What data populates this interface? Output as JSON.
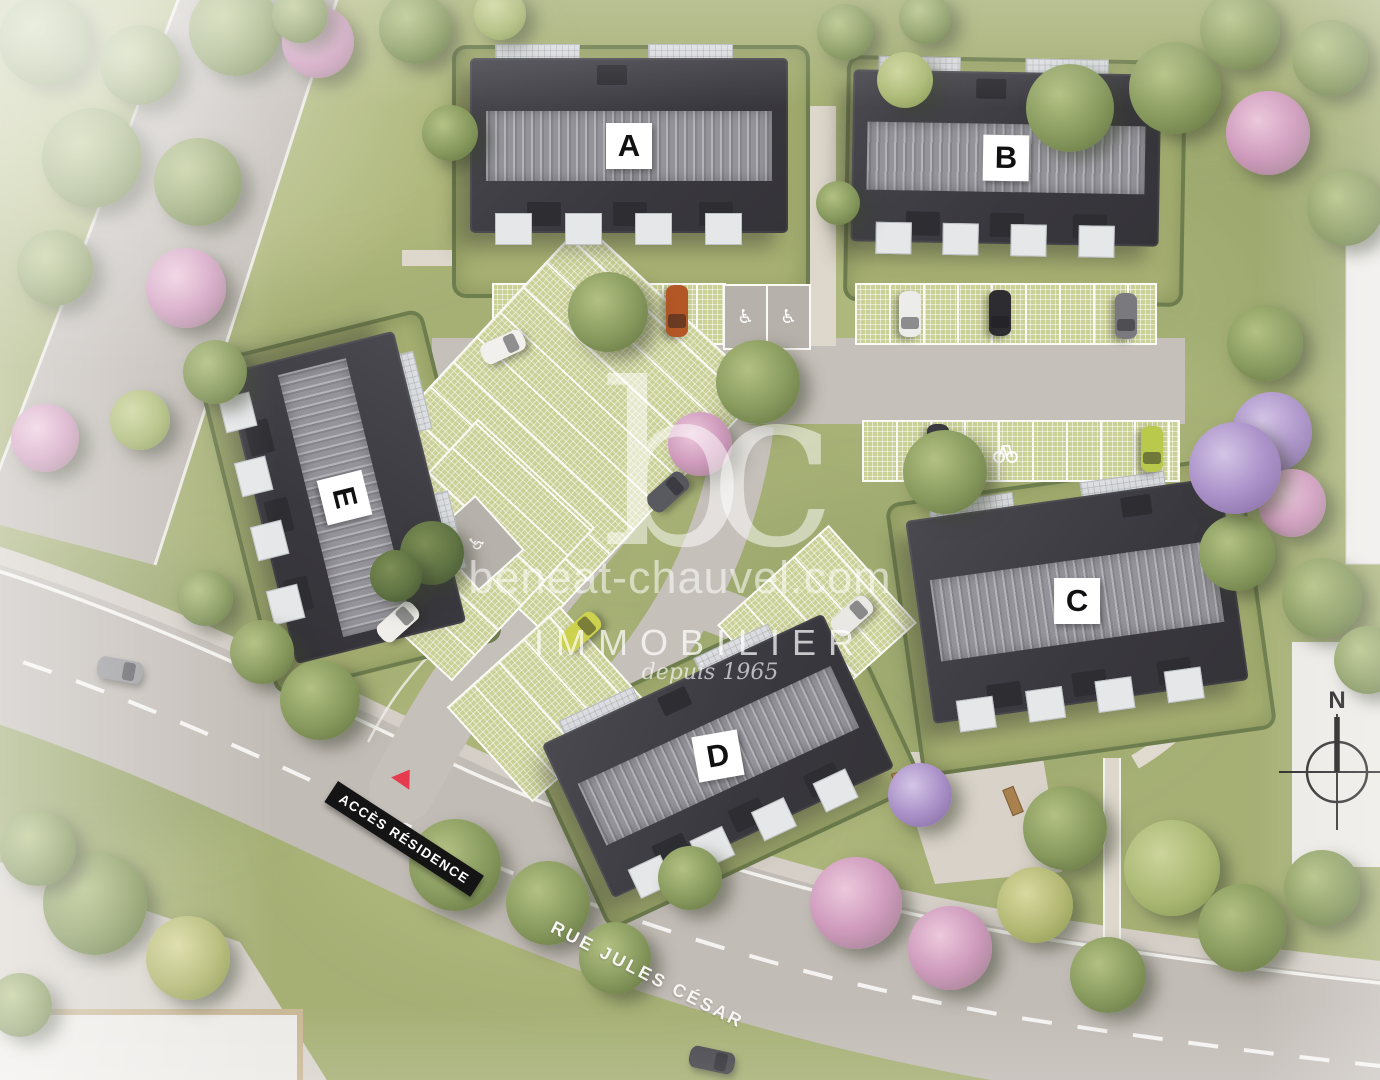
{
  "watermark": {
    "logo": "bc",
    "domain": "beneat-chauvel.com",
    "brand": "IMMOBILIER",
    "tagline": "depuis 1965"
  },
  "signs": {
    "access_residence": "ACCÈS RÉSIDENCE",
    "street_name": "RUE JULES CÉSAR",
    "compass_north": "N"
  },
  "buildings": [
    {
      "label": "A"
    },
    {
      "label": "B"
    },
    {
      "label": "C"
    },
    {
      "label": "D"
    },
    {
      "label": "E"
    }
  ],
  "icons": {
    "accessible_parking": "♿",
    "bike_rack": "bike-rack",
    "compass_rose": "compass-rose"
  },
  "colors": {
    "grass": "#a6b075",
    "roof": "#3f3e44",
    "roof_ridge": "#94939a",
    "road": "#c2bcb6",
    "paver_parking": "#cad096",
    "path": "#ded7cb",
    "label_bg": "#ffffff",
    "label_text": "#111111",
    "sign_bg": "#141414",
    "sign_text": "#ffffff",
    "sign_triangle": "#e63a4e",
    "watermark": "#ffffff"
  },
  "scene": {
    "paver_rows": [
      {
        "l": 492,
        "t": 283,
        "w": 234,
        "h": 62,
        "r": 0
      },
      {
        "l": 855,
        "t": 283,
        "w": 302,
        "h": 62,
        "r": 0
      },
      {
        "l": 862,
        "t": 420,
        "w": 318,
        "h": 62,
        "r": 0
      },
      {
        "l": 398,
        "t": 302,
        "w": 328,
        "h": 248,
        "r": -47
      },
      {
        "l": 360,
        "t": 470,
        "w": 210,
        "h": 160,
        "r": -47
      },
      {
        "l": 470,
        "t": 640,
        "w": 152,
        "h": 128,
        "r": -42
      },
      {
        "l": 742,
        "t": 558,
        "w": 150,
        "h": 132,
        "r": -42
      }
    ],
    "hc_stalls": [
      {
        "l": 723,
        "t": 284,
        "w": 84,
        "h": 62,
        "r": 0,
        "n": 2
      },
      {
        "l": 446,
        "t": 506,
        "w": 58,
        "h": 70,
        "r": -42,
        "n": 1
      }
    ],
    "cars": [
      {
        "x": 910,
        "y": 314,
        "r": 90,
        "c": "#ececea"
      },
      {
        "x": 1000,
        "y": 313,
        "r": 90,
        "c": "#2c2c31"
      },
      {
        "x": 1126,
        "y": 316,
        "r": 90,
        "c": "#7a7a7e"
      },
      {
        "x": 677,
        "y": 311,
        "r": 90,
        "c": "#b35726",
        "len": 52
      },
      {
        "x": 938,
        "y": 447,
        "r": 90,
        "c": "#3a3a40"
      },
      {
        "x": 1152,
        "y": 449,
        "r": 90,
        "c": "#b9c94c"
      },
      {
        "x": 503,
        "y": 347,
        "r": -25,
        "c": "#f1f0ed"
      },
      {
        "x": 668,
        "y": 492,
        "r": -42,
        "c": "#595960"
      },
      {
        "x": 580,
        "y": 632,
        "r": -42,
        "c": "#ccd14e"
      },
      {
        "x": 398,
        "y": 622,
        "r": -42,
        "c": "#efeeeb"
      },
      {
        "x": 852,
        "y": 616,
        "r": -42,
        "c": "#e9e8e4"
      },
      {
        "x": 120,
        "y": 670,
        "r": 10,
        "c": "#9a9a9e"
      },
      {
        "x": 712,
        "y": 1060,
        "r": 12,
        "c": "#46464c"
      }
    ],
    "benches": [
      {
        "x": 905,
        "y": 775,
        "r": -15
      },
      {
        "x": 1012,
        "y": 800,
        "r": 68
      }
    ],
    "trees": [
      {
        "x": 45,
        "y": 40,
        "rad": 46,
        "t": "g"
      },
      {
        "x": 140,
        "y": 65,
        "rad": 40,
        "t": "g"
      },
      {
        "x": 235,
        "y": 30,
        "rad": 46,
        "t": "g"
      },
      {
        "x": 318,
        "y": 42,
        "rad": 36,
        "t": "pk"
      },
      {
        "x": 300,
        "y": 15,
        "rad": 28,
        "t": "g"
      },
      {
        "x": 415,
        "y": 28,
        "rad": 36,
        "t": "g"
      },
      {
        "x": 500,
        "y": 14,
        "rad": 26,
        "t": "lg"
      },
      {
        "x": 92,
        "y": 158,
        "rad": 50,
        "t": "g"
      },
      {
        "x": 198,
        "y": 182,
        "rad": 44,
        "t": "g"
      },
      {
        "x": 55,
        "y": 268,
        "rad": 38,
        "t": "g"
      },
      {
        "x": 186,
        "y": 288,
        "rad": 40,
        "t": "pk"
      },
      {
        "x": 45,
        "y": 438,
        "rad": 34,
        "t": "pk"
      },
      {
        "x": 140,
        "y": 420,
        "rad": 30,
        "t": "lg"
      },
      {
        "x": 215,
        "y": 372,
        "rad": 32,
        "t": "g"
      },
      {
        "x": 845,
        "y": 32,
        "rad": 28,
        "t": "g"
      },
      {
        "x": 925,
        "y": 18,
        "rad": 26,
        "t": "g"
      },
      {
        "x": 905,
        "y": 80,
        "rad": 28,
        "t": "lg"
      },
      {
        "x": 1070,
        "y": 108,
        "rad": 44,
        "t": "g"
      },
      {
        "x": 1175,
        "y": 88,
        "rad": 46,
        "t": "g"
      },
      {
        "x": 1268,
        "y": 133,
        "rad": 42,
        "t": "pk"
      },
      {
        "x": 1345,
        "y": 208,
        "rad": 38,
        "t": "g"
      },
      {
        "x": 1240,
        "y": 30,
        "rad": 40,
        "t": "g"
      },
      {
        "x": 1330,
        "y": 58,
        "rad": 38,
        "t": "g"
      },
      {
        "x": 1265,
        "y": 343,
        "rad": 38,
        "t": "g"
      },
      {
        "x": 1272,
        "y": 432,
        "rad": 40,
        "t": "pu"
      },
      {
        "x": 1292,
        "y": 503,
        "rad": 34,
        "t": "pk"
      },
      {
        "x": 1237,
        "y": 553,
        "rad": 38,
        "t": "g"
      },
      {
        "x": 1322,
        "y": 598,
        "rad": 40,
        "t": "g"
      },
      {
        "x": 1368,
        "y": 660,
        "rad": 34,
        "t": "g"
      },
      {
        "x": 945,
        "y": 472,
        "rad": 42,
        "t": "g"
      },
      {
        "x": 1235,
        "y": 468,
        "rad": 46,
        "t": "pu"
      },
      {
        "x": 608,
        "y": 312,
        "rad": 40,
        "t": "g"
      },
      {
        "x": 758,
        "y": 382,
        "rad": 42,
        "t": "g"
      },
      {
        "x": 700,
        "y": 444,
        "rad": 32,
        "t": "pk"
      },
      {
        "x": 432,
        "y": 553,
        "rad": 32,
        "t": "dg"
      },
      {
        "x": 396,
        "y": 576,
        "rad": 26,
        "t": "dg"
      },
      {
        "x": 450,
        "y": 133,
        "rad": 28,
        "t": "g"
      },
      {
        "x": 838,
        "y": 203,
        "rad": 22,
        "t": "g"
      },
      {
        "x": 205,
        "y": 598,
        "rad": 28,
        "t": "g"
      },
      {
        "x": 262,
        "y": 652,
        "rad": 32,
        "t": "g"
      },
      {
        "x": 320,
        "y": 700,
        "rad": 40,
        "t": "g"
      },
      {
        "x": 95,
        "y": 903,
        "rad": 52,
        "t": "g"
      },
      {
        "x": 38,
        "y": 848,
        "rad": 38,
        "t": "g"
      },
      {
        "x": 188,
        "y": 958,
        "rad": 42,
        "t": "yg"
      },
      {
        "x": 20,
        "y": 1005,
        "rad": 32,
        "t": "g"
      },
      {
        "x": 455,
        "y": 865,
        "rad": 46,
        "t": "g"
      },
      {
        "x": 548,
        "y": 903,
        "rad": 42,
        "t": "g"
      },
      {
        "x": 615,
        "y": 958,
        "rad": 36,
        "t": "g"
      },
      {
        "x": 856,
        "y": 903,
        "rad": 46,
        "t": "pk"
      },
      {
        "x": 920,
        "y": 795,
        "rad": 32,
        "t": "pu"
      },
      {
        "x": 950,
        "y": 948,
        "rad": 42,
        "t": "pk"
      },
      {
        "x": 1065,
        "y": 828,
        "rad": 42,
        "t": "g"
      },
      {
        "x": 1172,
        "y": 868,
        "rad": 48,
        "t": "lg"
      },
      {
        "x": 1242,
        "y": 928,
        "rad": 44,
        "t": "g"
      },
      {
        "x": 1322,
        "y": 888,
        "rad": 38,
        "t": "g"
      },
      {
        "x": 1035,
        "y": 905,
        "rad": 38,
        "t": "yg"
      },
      {
        "x": 1108,
        "y": 975,
        "rad": 38,
        "t": "g"
      },
      {
        "x": 690,
        "y": 878,
        "rad": 32,
        "t": "g"
      }
    ]
  }
}
